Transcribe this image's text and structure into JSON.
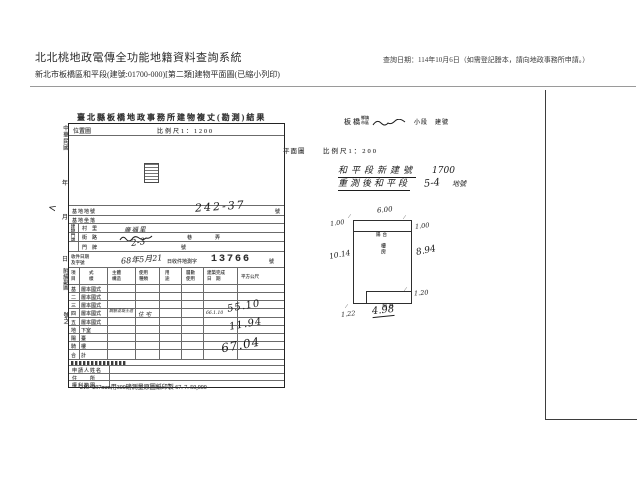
{
  "colors": {
    "paper": "#ffffff",
    "ink": "#2b2b2b"
  },
  "header": {
    "system_title": "北北桃地政電傳全功能地籍資料查詢系統",
    "query_date": "查詢日期：114年10月6日（如需登記謄本，請向地政事務所申請。）",
    "subtitle": "新北市板橋區和平段(建號:01700-000)[第二類]建物平面圖(已縮小列印)"
  },
  "left_margin": {
    "era": "中華民國",
    "year": "年",
    "month": "月",
    "day": "日",
    "attachment": "附繪副圖",
    "number_suffix": "號之"
  },
  "form": {
    "title": "臺北縣板橋地政事務所建物複丈(勘測)結果",
    "location_map": {
      "label": "位置圖",
      "scale": "比例尺1：1200"
    },
    "site": {
      "lot_label": "基地地號",
      "lot_value": "242-37",
      "lot_suffix": "號",
      "sit_label": "基地坐落",
      "door_group_label": "建物門牌",
      "village_label": "村　里",
      "village_value": "廣福里",
      "street_label": "街　路",
      "street_lane": "巷",
      "street_alley": "弄",
      "door_label": "門　牌",
      "door_value": "2-3",
      "door_suffix": "號"
    },
    "receipt": {
      "label": "收件日期\n及字號",
      "date": "68年5月21",
      "prefix": "日收件地測字",
      "number": "13766",
      "suffix": "號"
    },
    "area_table": {
      "headers": [
        "項\n目",
        "式\n樣",
        "主體\n構造",
        "使用\n種類",
        "用\n途",
        "層數\n使用",
        "建築完成\n日　期",
        "平方公尺"
      ],
      "rows": [
        {
          "floor": "基",
          "style": "層本國式"
        },
        {
          "floor": "二",
          "style": "層本國式"
        },
        {
          "floor": "三",
          "style": "層本國式"
        },
        {
          "floor": "四",
          "style": "層本國式",
          "structure": "鋼筋混凝土造",
          "use": "住宅",
          "date": "66.1.10",
          "area": "55.10"
        },
        {
          "floor": "五",
          "style": "層本國式"
        },
        {
          "floor": "地",
          "style": "下室"
        },
        {
          "floor": "陽",
          "style": "臺",
          "area": "11.94"
        },
        {
          "floor": "騎",
          "style": "樓"
        },
        {
          "floor": "合",
          "style": "計",
          "area": "67.04"
        }
      ]
    },
    "applicant": {
      "name_label": "申請人姓名",
      "address_label": "住　　所",
      "rights_label": "權利範圍"
    },
    "footer_note": "210×297mm用300磅測量原圖紙印製 67. 7. 50,000"
  },
  "plan": {
    "township_value": "板橋",
    "township_label": "鄉鎮\n市區",
    "section_label": "小段　建號",
    "view_label": "平面圖",
    "scale": "比例尺1：200",
    "note1": {
      "text": "和平段新建號",
      "number": "1700"
    },
    "note2": {
      "text": "重測後和平段",
      "number": "5-4",
      "suffix": "地號"
    },
    "drawing": {
      "center_label": "樓房",
      "balcony_top": "陽台",
      "balcony_bottom": "陽台",
      "dim_top": "6.00",
      "dim_top_left": "1.00",
      "dim_top_right": "1.00",
      "dim_left": "10.14",
      "dim_right": "8.94",
      "dim_bottom_right": "1.20",
      "dim_bottom_left": "1.22",
      "dim_bottom": "4.98"
    }
  }
}
